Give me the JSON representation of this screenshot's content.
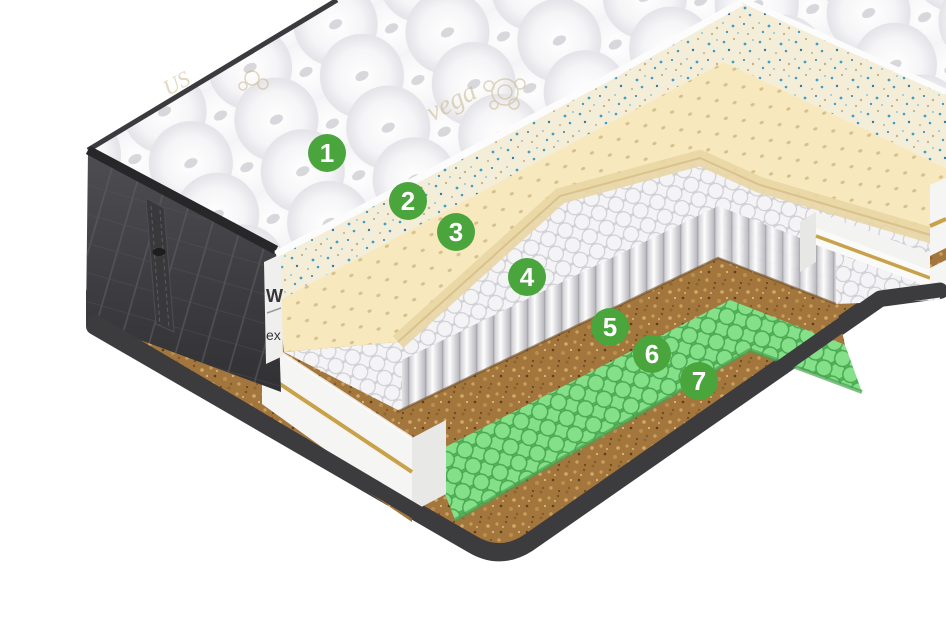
{
  "diagram": {
    "subject": "mattress-layers-cutaway",
    "badge_color": "#4aa53d",
    "badge_text_color": "#ffffff",
    "layers": [
      {
        "number": "1",
        "name": "quilted-pillow-top",
        "color": "#f6f6f8"
      },
      {
        "number": "2",
        "name": "speckled-foam-layer",
        "color": "#f4eed8"
      },
      {
        "number": "3",
        "name": "perforated-latex-foam",
        "color": "#f7e9bd"
      },
      {
        "number": "4",
        "name": "pocket-spring-block",
        "color": "#f2f2f4"
      },
      {
        "number": "5",
        "name": "coconut-coir-layer",
        "color": "#a6793c"
      },
      {
        "number": "6",
        "name": "micro-pocket-springs",
        "color": "#7fdd84"
      },
      {
        "number": "7",
        "name": "coconut-coir-base-layer",
        "color": "#9c713a"
      }
    ],
    "side_cover": {
      "color": "#454549",
      "label_fragments": {
        "line1": "W",
        "line2": "ex"
      }
    },
    "embroidery_fragments": {
      "script_text": "vega",
      "corner_text": "US"
    },
    "accents": {
      "gold_trim": "#c8a148",
      "bottom_rim": "#3c3c3f",
      "quilt_piping": "#2c2c30"
    }
  }
}
